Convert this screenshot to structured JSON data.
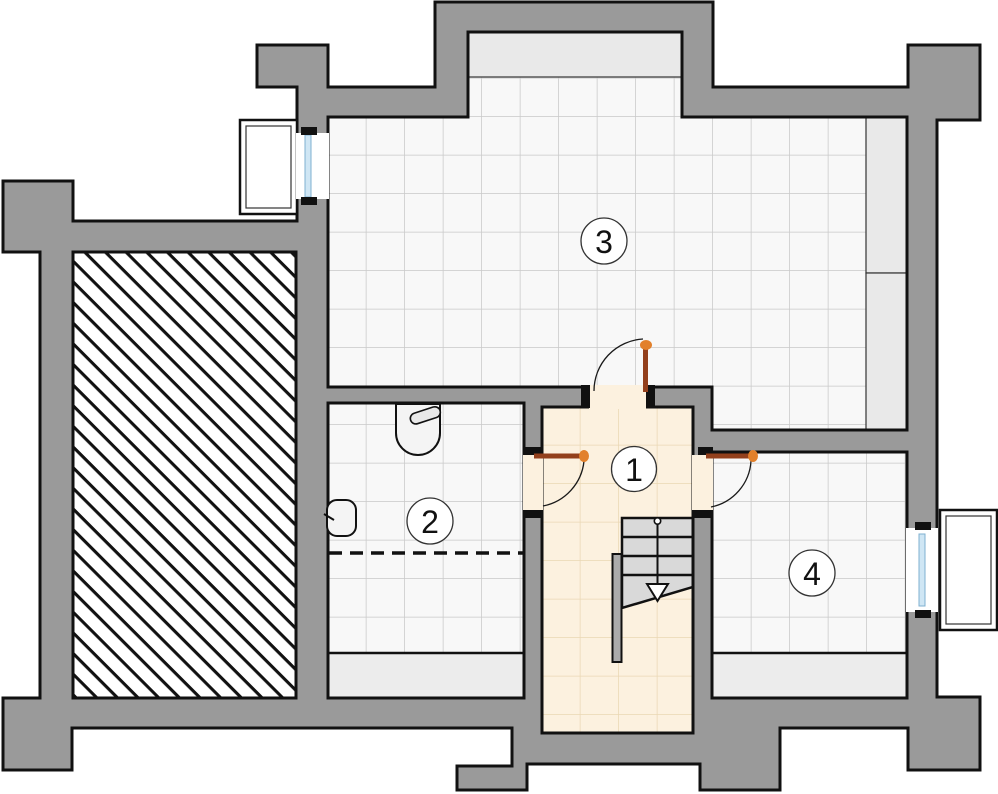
{
  "plan": {
    "kind": "basement-floor-plan",
    "rooms": [
      {
        "label": "1"
      },
      {
        "label": "2"
      },
      {
        "label": "3"
      },
      {
        "label": "4"
      }
    ],
    "colors": {
      "wall": "#9a9a9a",
      "outline": "#111111",
      "tile_floor": "#f8f8f8",
      "tile_grid": "#c9c9c9",
      "hall_floor": "#fcf1df",
      "hall_grid": "#ead7b4",
      "door_leaf": "#93401c",
      "door_pivot": "#e2802b",
      "glazing_fill": "#cfe6f4",
      "glazing_edge": "#7fb0d0",
      "strip_fill": "#e9e9e9",
      "stair_fill": "#d9d9d9",
      "handrail_fill": "#ababab",
      "hatch_line": "#111111"
    },
    "icons": {
      "washbasin": "washbasin-icon",
      "toilet": "toilet-icon",
      "stair_direction": "down-arrow-icon",
      "door_pivot": "pivot-dot-icon"
    }
  }
}
